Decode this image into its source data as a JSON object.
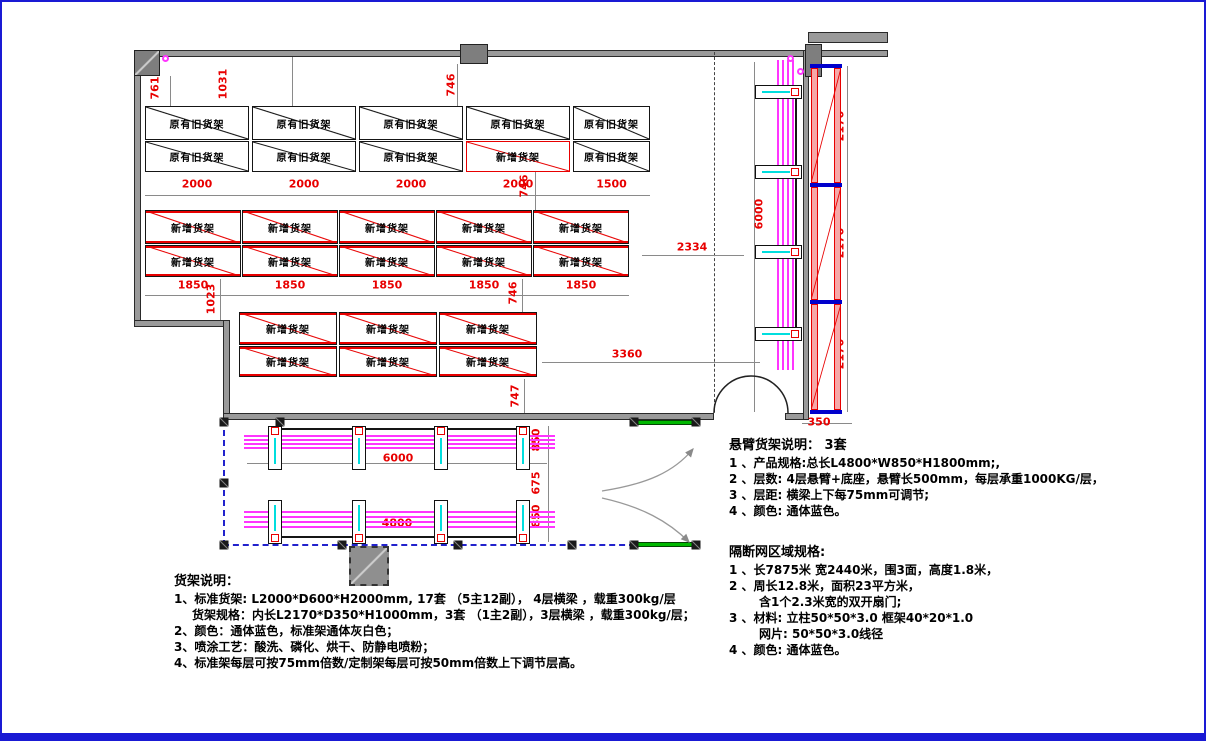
{
  "labels": {
    "old_rack": "原有旧货架",
    "new_rack": "新增货架"
  },
  "racks": {
    "group1": {
      "rows": [
        [
          "原有旧货架",
          "原有旧货架",
          "原有旧货架",
          "原有旧货架",
          "原有旧货架"
        ],
        [
          "原有旧货架",
          "原有旧货架",
          "原有旧货架",
          "新增货架",
          "原有旧货架"
        ]
      ],
      "dims": [
        "2000",
        "2000",
        "2000",
        "2000",
        "1500"
      ]
    },
    "group2": {
      "rows": [
        [
          "新增货架",
          "新增货架",
          "新增货架",
          "新增货架",
          "新增货架"
        ],
        [
          "新增货架",
          "新增货架",
          "新增货架",
          "新增货架",
          "新增货架"
        ]
      ],
      "dims": [
        "1850",
        "1850",
        "1850",
        "1850",
        "1850"
      ]
    },
    "group3": {
      "rows": [
        [
          "新增货架",
          "新增货架",
          "新增货架"
        ],
        [
          "新增货架",
          "新增货架",
          "新增货架"
        ]
      ],
      "dims": []
    }
  },
  "dims": {
    "d761": "761",
    "d1031": "1031",
    "d746_top": "746",
    "d746_g1": "746",
    "d1023": "1023",
    "d746_g2": "746",
    "d747": "747",
    "d2334": "2334",
    "d3360": "3360",
    "d6000_bottom": "6000",
    "d4800": "4800",
    "d850_a": "850",
    "d675": "675",
    "d850_b": "850",
    "d6000_right": "6000",
    "d2170_a": "2170",
    "d2170_b": "2170",
    "d2170_c": "2170",
    "d350": "350"
  },
  "notes_rack": {
    "title": "货架说明：",
    "lines": [
      "1、标准货架: L2000*D600*H2000mm, 17套 （5主12副）， 4层横梁 ，载重300kg/层",
      "货架规格：内长L2170*D350*H1000mm，3套 （1主2副），3层横梁 ，载重300kg/层；",
      "2、颜色：通体蓝色，标准架通体灰白色；",
      "3、喷涂工艺：酸洗、磷化、烘干、防静电喷粉；",
      "4、标准架每层可按75mm倍数/定制架每层可按50mm倍数上下调节层高。"
    ]
  },
  "notes_cantilever": {
    "title": "悬臂货架说明：  3套",
    "lines": [
      "1 、产品规格:总长L4800*W850*H1800mm;,",
      "2 、层数: 4层悬臂+底座，悬臂长500mm，每层承重1000KG/层，",
      "3 、层距: 横梁上下每75mm可调节;",
      "4 、颜色: 通体蓝色。"
    ]
  },
  "notes_fence": {
    "title": "隔断网区域规格:",
    "lines": [
      "1 、长7875米 宽2440米，围3面，高度1.8米，",
      "2 、周长12.8米，面积23平方米，",
      "含1个2.3米宽的双开扇门;",
      "3 、材料: 立柱50*50*3.0  框架40*20*1.0",
      "网片: 50*50*3.0线径",
      "4 、颜色: 通体蓝色。"
    ]
  },
  "colors": {
    "dim_text": "#e80000",
    "rack_new_red": "#e80000",
    "fence_blue": "#2222cc",
    "mesh_green": "#00b800",
    "cantilever_magenta": "#ff35ff",
    "detail_cyan": "#00dede",
    "cap_blue": "#0000cc",
    "page_border_blue": "#1a1ad4",
    "wall_gray": "#9a9a9a"
  }
}
